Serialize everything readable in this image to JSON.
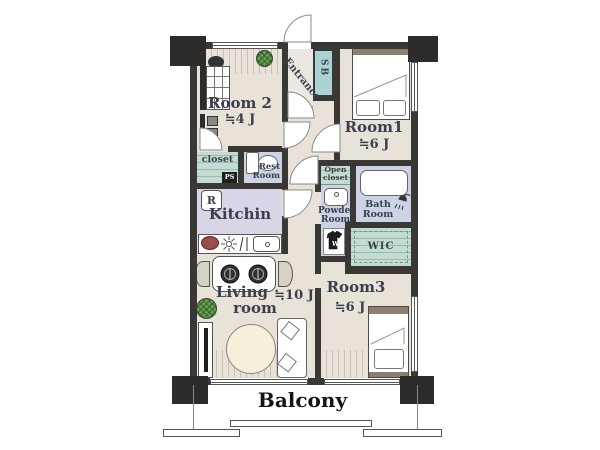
{
  "labels": {
    "room1": {
      "name": "Room1",
      "size": "≒6 J"
    },
    "room2": {
      "name": "Room 2",
      "size": "≒4 J"
    },
    "room3": {
      "name": "Room3",
      "size": "≒6 J"
    },
    "living": {
      "line1": "Living",
      "line2": "room",
      "size": "≒10 J"
    },
    "kitchen": {
      "name": "Kitchin",
      "fridge": "R"
    },
    "entrance": {
      "name": "Entrance",
      "shoebox": "SB"
    },
    "closet": {
      "name": "closet",
      "ps": "PS"
    },
    "rest_room": {
      "line1": "Rest",
      "line2": "Room"
    },
    "open_closet": {
      "line1": "Open",
      "line2": "closet"
    },
    "powder_room": {
      "line1": "Powder",
      "line2": "Room"
    },
    "bath_room": {
      "line1": "Bath",
      "line2": "Room"
    },
    "wic": {
      "name": "WIC"
    },
    "washer": {
      "mark": "W"
    },
    "balcony": {
      "name": "Balcony"
    }
  },
  "colors": {
    "wall": "#3a3835",
    "floor": "#e8e2d9",
    "wet_area": "#ccd3e5",
    "kitchen_floor": "#d8d5e7",
    "closet": "#c3dbd0",
    "shoebox": "#abd3d3",
    "label_text": "#39404c",
    "headboard": "#8d7f6f",
    "plant": "#6aa352",
    "table": "#f6efda"
  }
}
